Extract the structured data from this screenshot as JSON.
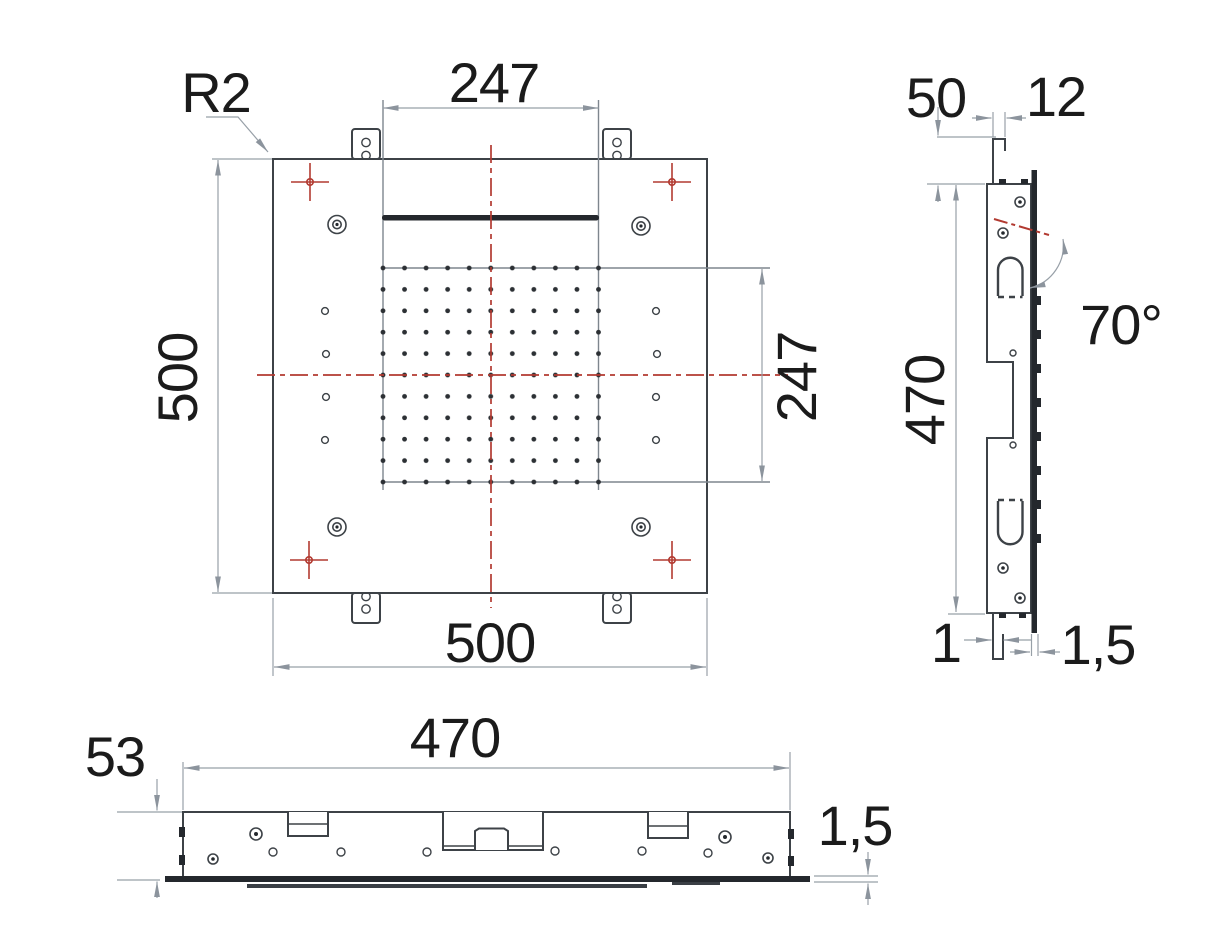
{
  "views": {
    "top": {
      "labels": {
        "radius": "R2",
        "inner_width": "247",
        "inner_height": "247",
        "outer_width": "500",
        "outer_height": "500"
      }
    },
    "side": {
      "labels": {
        "ceiling_offset": "50",
        "hook_width": "12",
        "spray_angle": "70°",
        "frame_height": "470",
        "hook_thickness": "1",
        "panel_thickness": "1,5"
      }
    },
    "front": {
      "labels": {
        "frame_height": "53",
        "frame_width": "470",
        "panel_thickness": "1,5"
      }
    }
  },
  "colors": {
    "outline": "#3d4247",
    "dimension_gray": "#98a0a8",
    "centerline_red": "#b23a31",
    "dark_fill": "#24282d",
    "text": "#1b1b1b"
  }
}
